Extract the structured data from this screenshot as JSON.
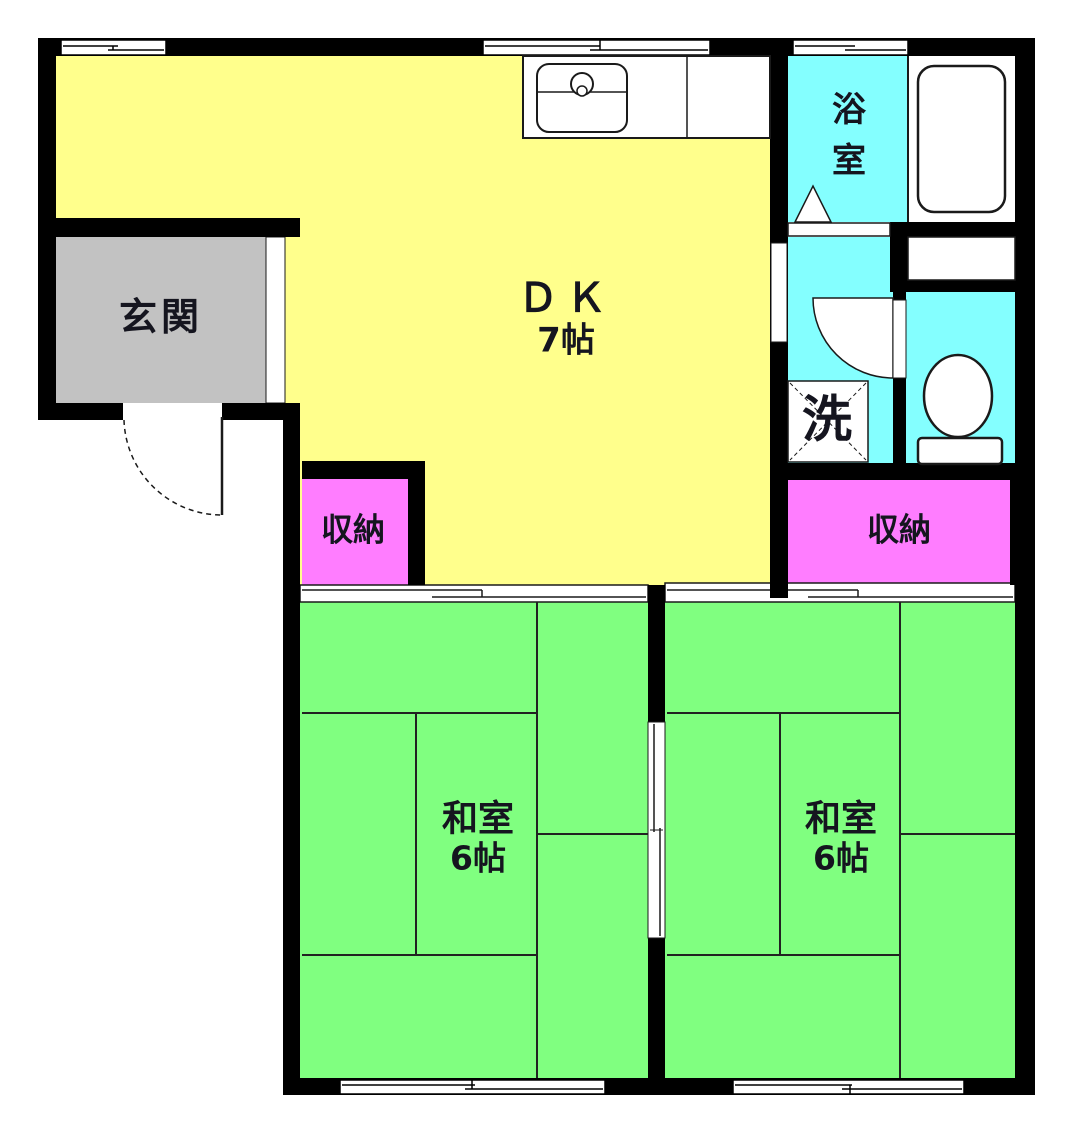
{
  "floorplan": {
    "rooms": {
      "dk": {
        "label": "ＤＫ",
        "size": "7帖"
      },
      "genkan": {
        "label": "玄関"
      },
      "bathroom": {
        "label": "浴室"
      },
      "laundry": {
        "label": "洗"
      },
      "storage_left": {
        "label": "収納"
      },
      "storage_right": {
        "label": "収納"
      },
      "washitsu_left": {
        "label": "和室",
        "size": "6帖"
      },
      "washitsu_right": {
        "label": "和室",
        "size": "6帖"
      }
    },
    "colors": {
      "dk": "#FFFF8C",
      "genkan": "#C2C2C2",
      "wet": "#84FFFF",
      "storage": "#FF7DFF",
      "tatami": "#80FF80",
      "wall": "#000000",
      "fixture": "#FFFFFF"
    },
    "fixtures": [
      "kitchen-sink",
      "kitchen-counter",
      "bathtub",
      "toilet",
      "washing-machine-space",
      "entrance-door-swing",
      "washroom-door-swing",
      "bathroom-folding-door",
      "sliding-door",
      "sliding-window"
    ]
  }
}
